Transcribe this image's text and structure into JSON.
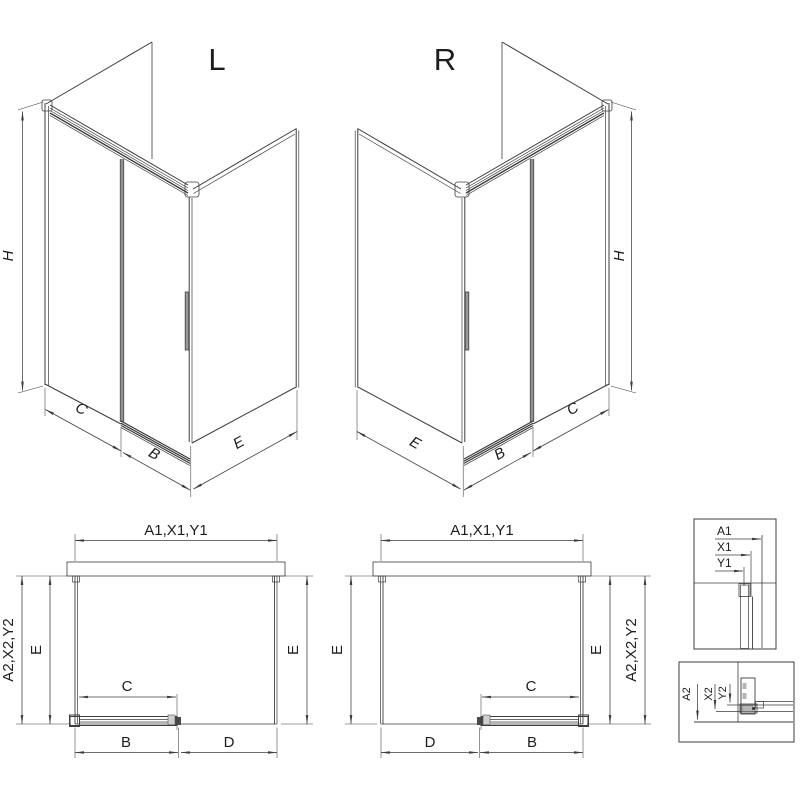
{
  "drawing_title": "Sliding door shower enclosure - L and R variants",
  "colors": {
    "line": "#3d3d3d",
    "door_gray": "#909090",
    "profile_gray": "#c6c6c6",
    "text": "#1d1d1d",
    "background": "#ffffff"
  },
  "iso_left": {
    "title": "L",
    "dim_height": "H",
    "dim_fixed": "C",
    "dim_door": "B",
    "dim_side": "E"
  },
  "iso_right": {
    "title": "R",
    "dim_height": "H",
    "dim_fixed": "C",
    "dim_door": "B",
    "dim_side": "E"
  },
  "plan_left": {
    "dim_top": "A1,X1,Y1",
    "dim_outer": "A2,X2,Y2",
    "dim_side_left": "E",
    "dim_side_right": "E",
    "dim_opening": "C",
    "dim_door": "B",
    "dim_fixed": "D"
  },
  "plan_right": {
    "dim_top": "A1,X1,Y1",
    "dim_outer": "A2,X2,Y2",
    "dim_side_left": "E",
    "dim_side_right": "E",
    "dim_opening": "C",
    "dim_door": "B",
    "dim_fixed": "D"
  },
  "detail_wall_profile": {
    "a1": "A1",
    "x1": "X1",
    "y1": "Y1"
  },
  "detail_floor_profile": {
    "a2": "A2",
    "x2": "X2",
    "y2": "Y2"
  }
}
